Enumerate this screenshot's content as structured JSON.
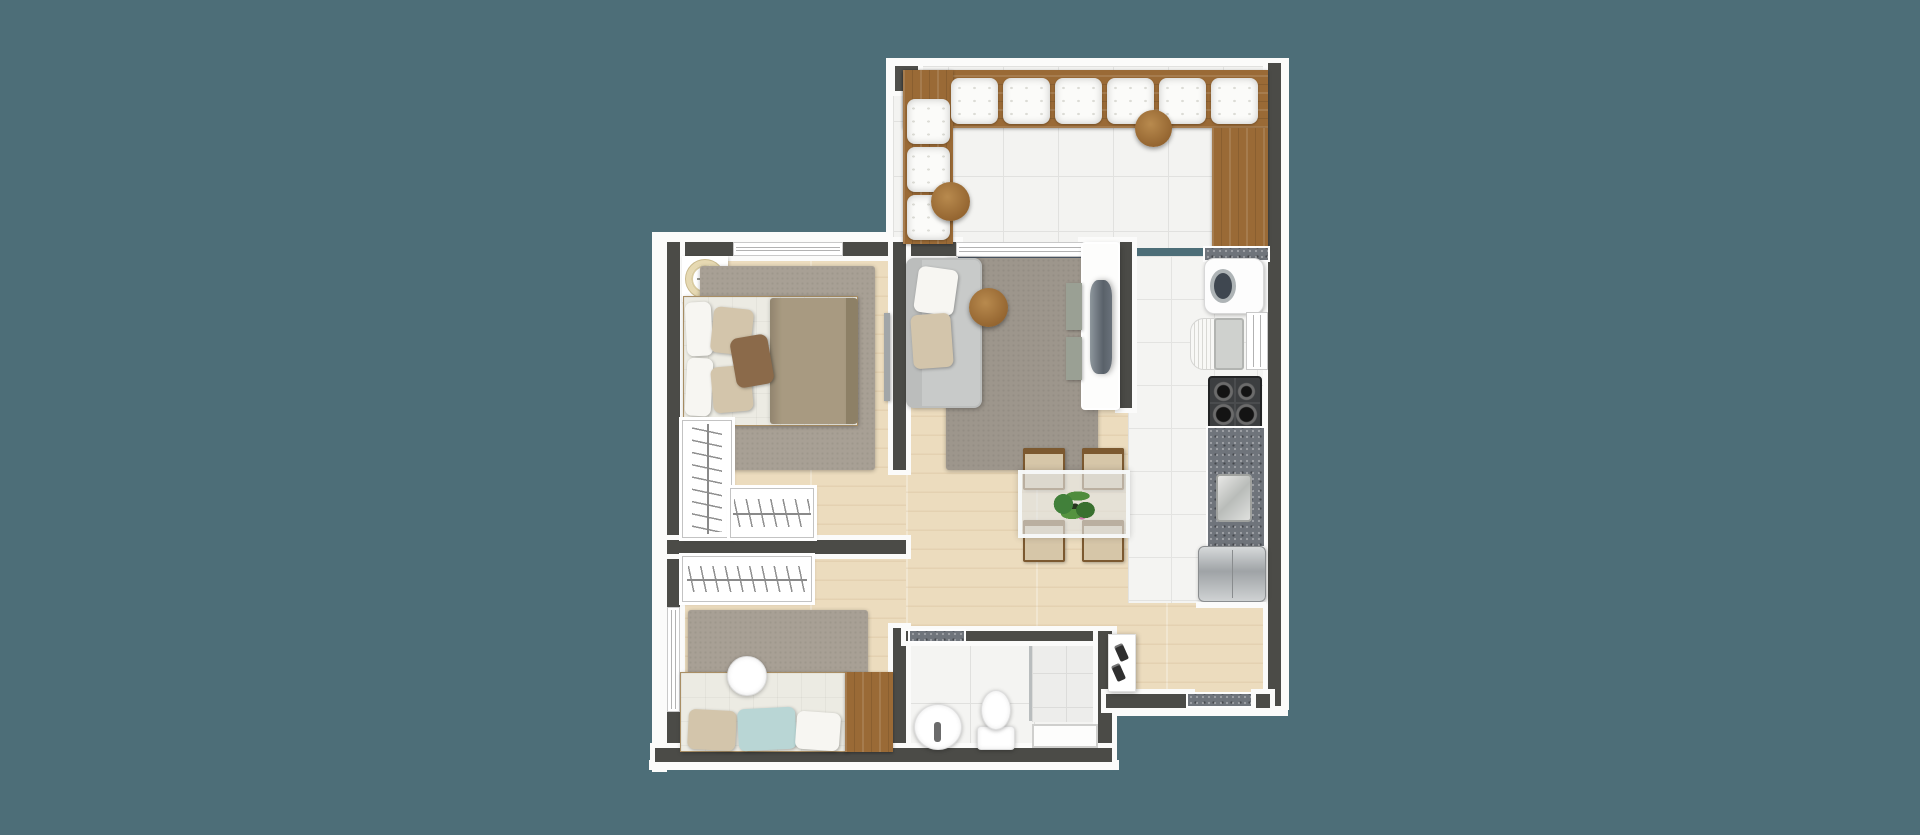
{
  "scene": {
    "type": "apartment-floor-plan-render",
    "view": "top-down",
    "palette": {
      "background": "#4d6e78",
      "wall": "#4b4b47",
      "outline": "#fbfbfa",
      "wood_floor": "#ecdcbe",
      "tile_floor": "#f3f3f1",
      "bench_wood": "#9a6a36",
      "rug_gray": "#9d968c",
      "granite_counter": "#6f747b",
      "sofa_gray": "#c8cac9",
      "duvet_taupe": "#a89a81",
      "pillow_blue": "#b9d6d5"
    },
    "rooms": [
      {
        "name": "balcony-terrace",
        "floor": "white-tile",
        "furniture": [
          "l-shaped-bench",
          "bench-cushions",
          "round-side-tables",
          "pillar"
        ]
      },
      {
        "name": "kitchen",
        "floor": "white-tile",
        "furniture": [
          "cabinet",
          "washing-machine",
          "sink",
          "window",
          "stove",
          "granite-counter",
          "counter-sink",
          "fridge"
        ]
      },
      {
        "name": "living-dining-room",
        "floor": "wood",
        "furniture": [
          "sofa",
          "coffee-table",
          "rug",
          "tv-panel",
          "media-shelves",
          "dining-table",
          "dining-chairs",
          "plant"
        ]
      },
      {
        "name": "bedroom-1",
        "floor": "wood",
        "furniture": [
          "ceiling-fan",
          "double-bed",
          "rug",
          "mirror",
          "l-shaped-closet",
          "window"
        ]
      },
      {
        "name": "bedroom-2",
        "floor": "wood",
        "furniture": [
          "closet",
          "rug",
          "single-bed",
          "round-side-table",
          "desk-cabinet",
          "window"
        ]
      },
      {
        "name": "bathroom",
        "floor": "white-tile",
        "furniture": [
          "sink",
          "toilet",
          "shower-box",
          "ledge"
        ]
      },
      {
        "name": "entry-hall",
        "floor": "wood",
        "furniture": [
          "shoe-shelf",
          "granite-threshold"
        ]
      }
    ],
    "elements": [
      {
        "n": "trim-balcony-top",
        "cls": "white",
        "x": 886,
        "y": 58,
        "w": 402,
        "h": 12
      },
      {
        "n": "trim-balcony-left",
        "cls": "white",
        "x": 886,
        "y": 58,
        "w": 17,
        "h": 192
      },
      {
        "n": "trim-right",
        "cls": "white",
        "x": 1281,
        "y": 58,
        "w": 8,
        "h": 652
      },
      {
        "n": "trim-left",
        "cls": "white",
        "x": 652,
        "y": 232,
        "w": 15,
        "h": 540
      },
      {
        "n": "trim-top-bedroom",
        "cls": "white",
        "x": 652,
        "y": 232,
        "w": 243,
        "h": 10
      },
      {
        "n": "trim-bottom",
        "cls": "white",
        "x": 649,
        "y": 760,
        "w": 470,
        "h": 10
      },
      {
        "n": "trim-bottom-entry",
        "cls": "white",
        "x": 1106,
        "y": 706,
        "w": 182,
        "h": 10
      },
      {
        "n": "floor-bedroom1",
        "cls": "wood",
        "x": 680,
        "y": 256,
        "w": 226,
        "h": 288
      },
      {
        "n": "floor-bedroom2",
        "cls": "wood",
        "x": 680,
        "y": 550,
        "w": 226,
        "h": 202
      },
      {
        "n": "floor-living-hall",
        "cls": "wood",
        "x": 906,
        "y": 256,
        "w": 362,
        "h": 446
      },
      {
        "n": "floor-balcony",
        "cls": "tile",
        "x": 893,
        "y": 66,
        "w": 375,
        "h": 182
      },
      {
        "n": "floor-kitchen",
        "cls": "tile-sm",
        "x": 1128,
        "y": 256,
        "w": 140,
        "h": 347
      },
      {
        "n": "floor-bathroom",
        "cls": "tile-bath",
        "x": 906,
        "y": 639,
        "w": 196,
        "h": 113
      },
      {
        "n": "floor-shower",
        "cls": "tile-shower",
        "x": 1032,
        "y": 639,
        "w": 68,
        "h": 83
      },
      {
        "n": "shower-glass-partition",
        "x": 1029,
        "y": 641,
        "w": 3,
        "h": 80,
        "bg": "#b9bdbe"
      },
      {
        "n": "pillar-frame",
        "cls": "white",
        "x": 890,
        "y": 61,
        "w": 33,
        "h": 35
      },
      {
        "n": "pillar",
        "x": 895,
        "y": 66,
        "w": 23,
        "h": 25,
        "bg": "#4f4f4b"
      },
      {
        "n": "wall-right",
        "cls": "wall",
        "x": 1268,
        "y": 63,
        "w": 13,
        "h": 643
      },
      {
        "n": "wall-bedroom1-top",
        "cls": "wall",
        "x": 667,
        "y": 242,
        "w": 291,
        "h": 14
      },
      {
        "n": "bedroom1-window",
        "cls": "window-h",
        "x": 733,
        "y": 242,
        "w": 110,
        "h": 14
      },
      {
        "n": "wall-living-top",
        "cls": "wall",
        "x": 1083,
        "y": 242,
        "w": 49,
        "h": 14
      },
      {
        "n": "wall-living-kitchen",
        "cls": "wall",
        "x": 1120,
        "y": 242,
        "w": 12,
        "h": 166
      },
      {
        "n": "wall-left",
        "cls": "wall",
        "x": 667,
        "y": 242,
        "w": 13,
        "h": 520
      },
      {
        "n": "bedroom2-window",
        "cls": "window-v",
        "x": 667,
        "y": 607,
        "w": 13,
        "h": 105
      },
      {
        "n": "wall-bedrooms-divider",
        "cls": "wall",
        "x": 667,
        "y": 540,
        "w": 239,
        "h": 14
      },
      {
        "n": "wall-corridor",
        "cls": "wall",
        "x": 893,
        "y": 242,
        "w": 13,
        "h": 228
      },
      {
        "n": "wall-bathroom-left",
        "cls": "wall",
        "x": 893,
        "y": 628,
        "w": 13,
        "h": 134
      },
      {
        "n": "wall-bathroom-top",
        "cls": "wall",
        "x": 906,
        "y": 631,
        "w": 206,
        "h": 10
      },
      {
        "n": "bathroom-threshold",
        "cls": "granite",
        "x": 910,
        "y": 631,
        "w": 54,
        "h": 10
      },
      {
        "n": "wall-bathroom-right",
        "cls": "wall",
        "x": 1098,
        "y": 631,
        "w": 14,
        "h": 131
      },
      {
        "n": "wall-bottom",
        "cls": "wall",
        "x": 655,
        "y": 748,
        "w": 457,
        "h": 14
      },
      {
        "n": "wall-entry-bottom",
        "cls": "wall",
        "x": 1106,
        "y": 694,
        "w": 84,
        "h": 14
      },
      {
        "n": "entry-threshold",
        "cls": "granite",
        "x": 1188,
        "y": 694,
        "w": 74,
        "h": 12
      },
      {
        "n": "wall-entry-corner",
        "cls": "wall",
        "x": 1256,
        "y": 694,
        "w": 14,
        "h": 14
      },
      {
        "n": "balcony-sliding-door",
        "cls": "window-h",
        "x": 956,
        "y": 242,
        "w": 129,
        "h": 15
      },
      {
        "n": "sliding-door-track",
        "cls": "track",
        "x": 958,
        "y": 257,
        "w": 125,
        "h": 6
      },
      {
        "n": "bench-top",
        "cls": "woodcab grain-h",
        "x": 903,
        "y": 70,
        "w": 365,
        "h": 58
      },
      {
        "n": "bench-left",
        "cls": "woodcab grain-v",
        "x": 903,
        "y": 70,
        "w": 50,
        "h": 174
      },
      {
        "n": "bench-cushion",
        "cls": "cushion",
        "x": 951,
        "y": 78,
        "w": 47,
        "h": 46
      },
      {
        "n": "bench-cushion",
        "cls": "cushion",
        "x": 1003,
        "y": 78,
        "w": 47,
        "h": 46
      },
      {
        "n": "bench-cushion",
        "cls": "cushion",
        "x": 1055,
        "y": 78,
        "w": 47,
        "h": 46
      },
      {
        "n": "bench-cushion",
        "cls": "cushion",
        "x": 1107,
        "y": 78,
        "w": 47,
        "h": 46
      },
      {
        "n": "bench-cushion",
        "cls": "cushion",
        "x": 1159,
        "y": 78,
        "w": 47,
        "h": 46
      },
      {
        "n": "bench-cushion",
        "cls": "cushion",
        "x": 1211,
        "y": 78,
        "w": 47,
        "h": 46
      },
      {
        "n": "bench-cushion",
        "cls": "cushion",
        "x": 907,
        "y": 99,
        "w": 43,
        "h": 45
      },
      {
        "n": "bench-cushion",
        "cls": "cushion",
        "x": 907,
        "y": 147,
        "w": 43,
        "h": 45
      },
      {
        "n": "bench-cushion",
        "cls": "cushion",
        "x": 907,
        "y": 195,
        "w": 43,
        "h": 45
      },
      {
        "n": "balcony-round-table",
        "cls": "roundtab",
        "x": 931,
        "y": 182,
        "w": 39,
        "h": 39
      },
      {
        "n": "balcony-round-table",
        "cls": "roundtab",
        "x": 1135,
        "y": 110,
        "w": 37,
        "h": 37
      },
      {
        "n": "kitchen-cabinet",
        "cls": "woodcab grain-v",
        "x": 1212,
        "y": 128,
        "w": 56,
        "h": 122
      },
      {
        "n": "counter-granite-strip",
        "cls": "granite",
        "x": 1205,
        "y": 248,
        "w": 63,
        "h": 12
      },
      {
        "n": "washing-machine",
        "cls": "washer",
        "x": 1204,
        "y": 258,
        "w": 60,
        "h": 56
      },
      {
        "n": "sink-drainboard",
        "cls": "drainboard",
        "x": 1190,
        "y": 318,
        "w": 26,
        "h": 52
      },
      {
        "n": "kitchen-sink-basin",
        "cls": "basin",
        "x": 1214,
        "y": 318,
        "w": 30,
        "h": 52
      },
      {
        "n": "kitchen-window",
        "cls": "window-v",
        "x": 1246,
        "y": 312,
        "w": 22,
        "h": 58
      },
      {
        "n": "stove",
        "cls": "stove",
        "x": 1208,
        "y": 376,
        "w": 54,
        "h": 54
      },
      {
        "n": "counter-granite",
        "cls": "granite",
        "x": 1208,
        "y": 428,
        "w": 56,
        "h": 118
      },
      {
        "n": "counter-steel-sink",
        "cls": "steel",
        "x": 1216,
        "y": 474,
        "w": 36,
        "h": 48
      },
      {
        "n": "fridge",
        "cls": "fridge",
        "x": 1198,
        "y": 546,
        "w": 68,
        "h": 56
      },
      {
        "n": "fridge-trim",
        "cls": "white",
        "x": 1196,
        "y": 602,
        "w": 70,
        "h": 6
      },
      {
        "n": "living-rug",
        "cls": "rug",
        "x": 946,
        "y": 258,
        "w": 152,
        "h": 212
      },
      {
        "n": "sofa",
        "cls": "sofa",
        "x": 906,
        "y": 258,
        "w": 76,
        "h": 150
      },
      {
        "n": "sofa-pillow",
        "cls": "pillow-white",
        "x": 916,
        "y": 268,
        "w": 40,
        "h": 46,
        "rot": 8
      },
      {
        "n": "sofa-pillow",
        "cls": "pillow-beige",
        "x": 912,
        "y": 314,
        "w": 40,
        "h": 54,
        "rot": -4
      },
      {
        "n": "coffee-table",
        "cls": "roundtab",
        "x": 969,
        "y": 288,
        "w": 39,
        "h": 39
      },
      {
        "n": "tv-panel",
        "cls": "tvpanel",
        "x": 1083,
        "y": 244,
        "w": 35,
        "h": 164
      },
      {
        "n": "tv",
        "cls": "tv",
        "x": 1090,
        "y": 280,
        "w": 22,
        "h": 94
      },
      {
        "n": "media-shelf",
        "cls": "mediabox",
        "x": 1066,
        "y": 283,
        "w": 16,
        "h": 47
      },
      {
        "n": "media-shelf",
        "cls": "mediabox",
        "x": 1066,
        "y": 337,
        "w": 16,
        "h": 43
      },
      {
        "n": "dining-chair",
        "cls": "chair",
        "x": 1023,
        "y": 448,
        "w": 42,
        "h": 42
      },
      {
        "n": "dining-chair",
        "cls": "chair",
        "x": 1082,
        "y": 448,
        "w": 42,
        "h": 42
      },
      {
        "n": "dining-chair",
        "cls": "chair",
        "x": 1023,
        "y": 520,
        "w": 42,
        "h": 42
      },
      {
        "n": "dining-chair",
        "cls": "chair",
        "x": 1082,
        "y": 520,
        "w": 42,
        "h": 42
      },
      {
        "n": "dining-table",
        "cls": "glass",
        "x": 1018,
        "y": 470,
        "w": 112,
        "h": 68
      },
      {
        "n": "table-plant",
        "cls": "plant",
        "x": 1046,
        "y": 486,
        "w": 58,
        "h": 40
      },
      {
        "n": "fan-niche",
        "cls": "niche",
        "x": 682,
        "y": 256,
        "w": 46,
        "h": 46
      },
      {
        "n": "ceiling-fan",
        "cls": "fan",
        "x": 686,
        "y": 260,
        "w": 38,
        "h": 38
      },
      {
        "n": "bedroom1-rug",
        "cls": "rug2",
        "x": 700,
        "y": 266,
        "w": 175,
        "h": 204
      },
      {
        "n": "bed1-base",
        "cls": "bedbase",
        "x": 683,
        "y": 296,
        "w": 175,
        "h": 130
      },
      {
        "n": "bed1-duvet",
        "cls": "duvet",
        "x": 770,
        "y": 298,
        "w": 86,
        "h": 126
      },
      {
        "n": "bed1-duvet-fold",
        "x": 846,
        "y": 298,
        "w": 12,
        "h": 126,
        "bg": "#8d8066",
        "r": "0 4px 4px 0"
      },
      {
        "n": "bed1-pillow",
        "cls": "pillow-white",
        "x": 686,
        "y": 302,
        "w": 26,
        "h": 54,
        "rot": -3
      },
      {
        "n": "bed1-pillow",
        "cls": "pillow-white",
        "x": 686,
        "y": 358,
        "w": 26,
        "h": 58,
        "rot": 3
      },
      {
        "n": "bed1-pillow",
        "cls": "pillow-beige",
        "x": 712,
        "y": 308,
        "w": 40,
        "h": 46,
        "rot": 6
      },
      {
        "n": "bed1-pillow",
        "cls": "pillow-beige",
        "x": 712,
        "y": 366,
        "w": 40,
        "h": 46,
        "rot": -5
      },
      {
        "n": "bed1-accent-pillow",
        "cls": "pillow-brown",
        "x": 733,
        "y": 336,
        "w": 38,
        "h": 50,
        "rot": -10
      },
      {
        "n": "bedroom1-mirror",
        "cls": "mirror",
        "x": 884,
        "y": 313,
        "w": 6,
        "h": 88
      },
      {
        "n": "bedroom1-closet-tall",
        "cls": "closet closet-v",
        "x": 682,
        "y": 420,
        "w": 50,
        "h": 118
      },
      {
        "n": "bedroom1-closet-low",
        "cls": "closet closet-h",
        "x": 730,
        "y": 488,
        "w": 84,
        "h": 50
      },
      {
        "n": "bedroom2-closet",
        "cls": "closet closet-h",
        "x": 682,
        "y": 556,
        "w": 130,
        "h": 46
      },
      {
        "n": "bedroom2-rug",
        "cls": "rug2",
        "x": 688,
        "y": 610,
        "w": 180,
        "h": 74
      },
      {
        "n": "bed2-base",
        "cls": "bedbase",
        "x": 680,
        "y": 672,
        "w": 167,
        "h": 80
      },
      {
        "n": "bed2-pillow",
        "cls": "pillow-beige",
        "x": 688,
        "y": 710,
        "w": 48,
        "h": 40,
        "rot": 3
      },
      {
        "n": "bed2-pillow",
        "cls": "pillow-blue",
        "x": 738,
        "y": 708,
        "w": 58,
        "h": 42,
        "rot": -3
      },
      {
        "n": "bed2-pillow",
        "cls": "pillow-white",
        "x": 796,
        "y": 712,
        "w": 44,
        "h": 38,
        "rot": 4
      },
      {
        "n": "bedroom2-desk",
        "cls": "woodcab grain-v",
        "x": 845,
        "y": 672,
        "w": 48,
        "h": 80
      },
      {
        "n": "bedroom2-side-table",
        "cls": "porcelain ellipse",
        "x": 727,
        "y": 656,
        "w": 40,
        "h": 40
      },
      {
        "n": "shower-ledge",
        "cls": "ledge",
        "x": 1032,
        "y": 724,
        "w": 66,
        "h": 24
      },
      {
        "n": "bathroom-sink",
        "cls": "porcelain ellipse",
        "x": 914,
        "y": 704,
        "w": 48,
        "h": 46
      },
      {
        "n": "sink-pedestal",
        "x": 934,
        "y": 722,
        "w": 7,
        "h": 20,
        "bg": "#6b6b6b",
        "r": "3px"
      },
      {
        "n": "toilet-tank",
        "cls": "porcelain",
        "x": 977,
        "y": 726,
        "w": 38,
        "h": 24,
        "r": "4px"
      },
      {
        "n": "toilet-bowl",
        "cls": "porcelain ellipse",
        "x": 981,
        "y": 690,
        "w": 30,
        "h": 40
      },
      {
        "n": "entry-shoe-shelf",
        "cls": "shelfbox",
        "x": 1108,
        "y": 634,
        "w": 28,
        "h": 58
      },
      {
        "n": "shoe",
        "cls": "shoe",
        "x": 1117,
        "y": 644,
        "w": 9,
        "h": 17,
        "rot": -24
      },
      {
        "n": "shoe",
        "cls": "shoe",
        "x": 1114,
        "y": 664,
        "w": 9,
        "h": 17,
        "rot": -24
      }
    ]
  }
}
